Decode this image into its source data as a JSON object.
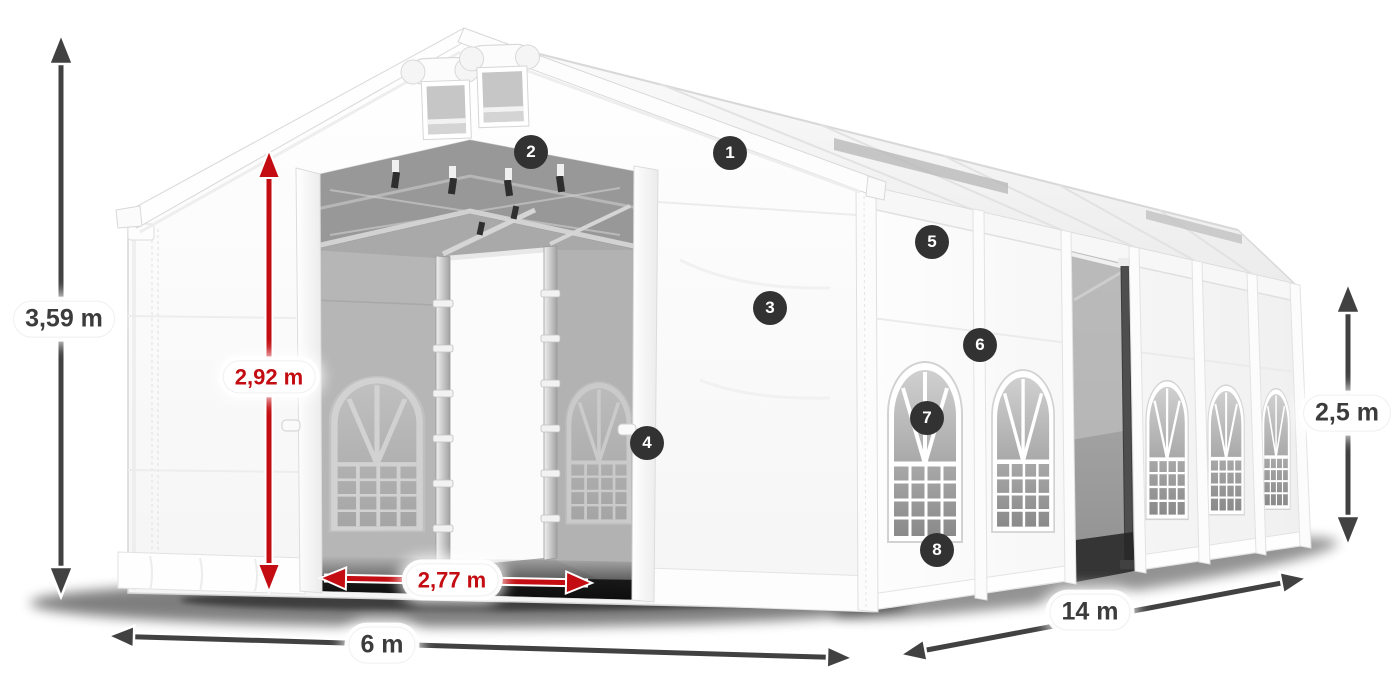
{
  "figure": {
    "type": "product-dimension-diagram",
    "subject": "white marquee storage tent with open front doors, roof vents and arched side windows",
    "background_color": "#ffffff",
    "colors": {
      "dimension_arrow_dark": "#414141",
      "dimension_arrow_red": "#c30d12",
      "label_background": "#ffffff",
      "label_text_dark": "#3c3c3c",
      "label_text_red": "#c30d12",
      "badge_background": "#323232",
      "badge_text": "#ffffff",
      "tent_fabric": "#fdfdfd",
      "interior_shadow": "#a9a9a9"
    },
    "dimensions": [
      {
        "id": "overall-height",
        "label": "3,59 m",
        "style": "dark",
        "orientation": "vertical"
      },
      {
        "id": "entrance-height",
        "label": "2,92 m",
        "style": "red",
        "orientation": "vertical"
      },
      {
        "id": "entrance-width",
        "label": "2,77 m",
        "style": "red",
        "orientation": "horizontal"
      },
      {
        "id": "tent-width",
        "label": "6 m",
        "style": "dark",
        "orientation": "horizontal"
      },
      {
        "id": "tent-length",
        "label": "14 m",
        "style": "dark",
        "orientation": "diagonal"
      },
      {
        "id": "side-height",
        "label": "2,5 m",
        "style": "dark",
        "orientation": "vertical"
      }
    ],
    "hotspots": [
      {
        "number": "1"
      },
      {
        "number": "2"
      },
      {
        "number": "3"
      },
      {
        "number": "4"
      },
      {
        "number": "5"
      },
      {
        "number": "6"
      },
      {
        "number": "7"
      },
      {
        "number": "8"
      }
    ]
  }
}
